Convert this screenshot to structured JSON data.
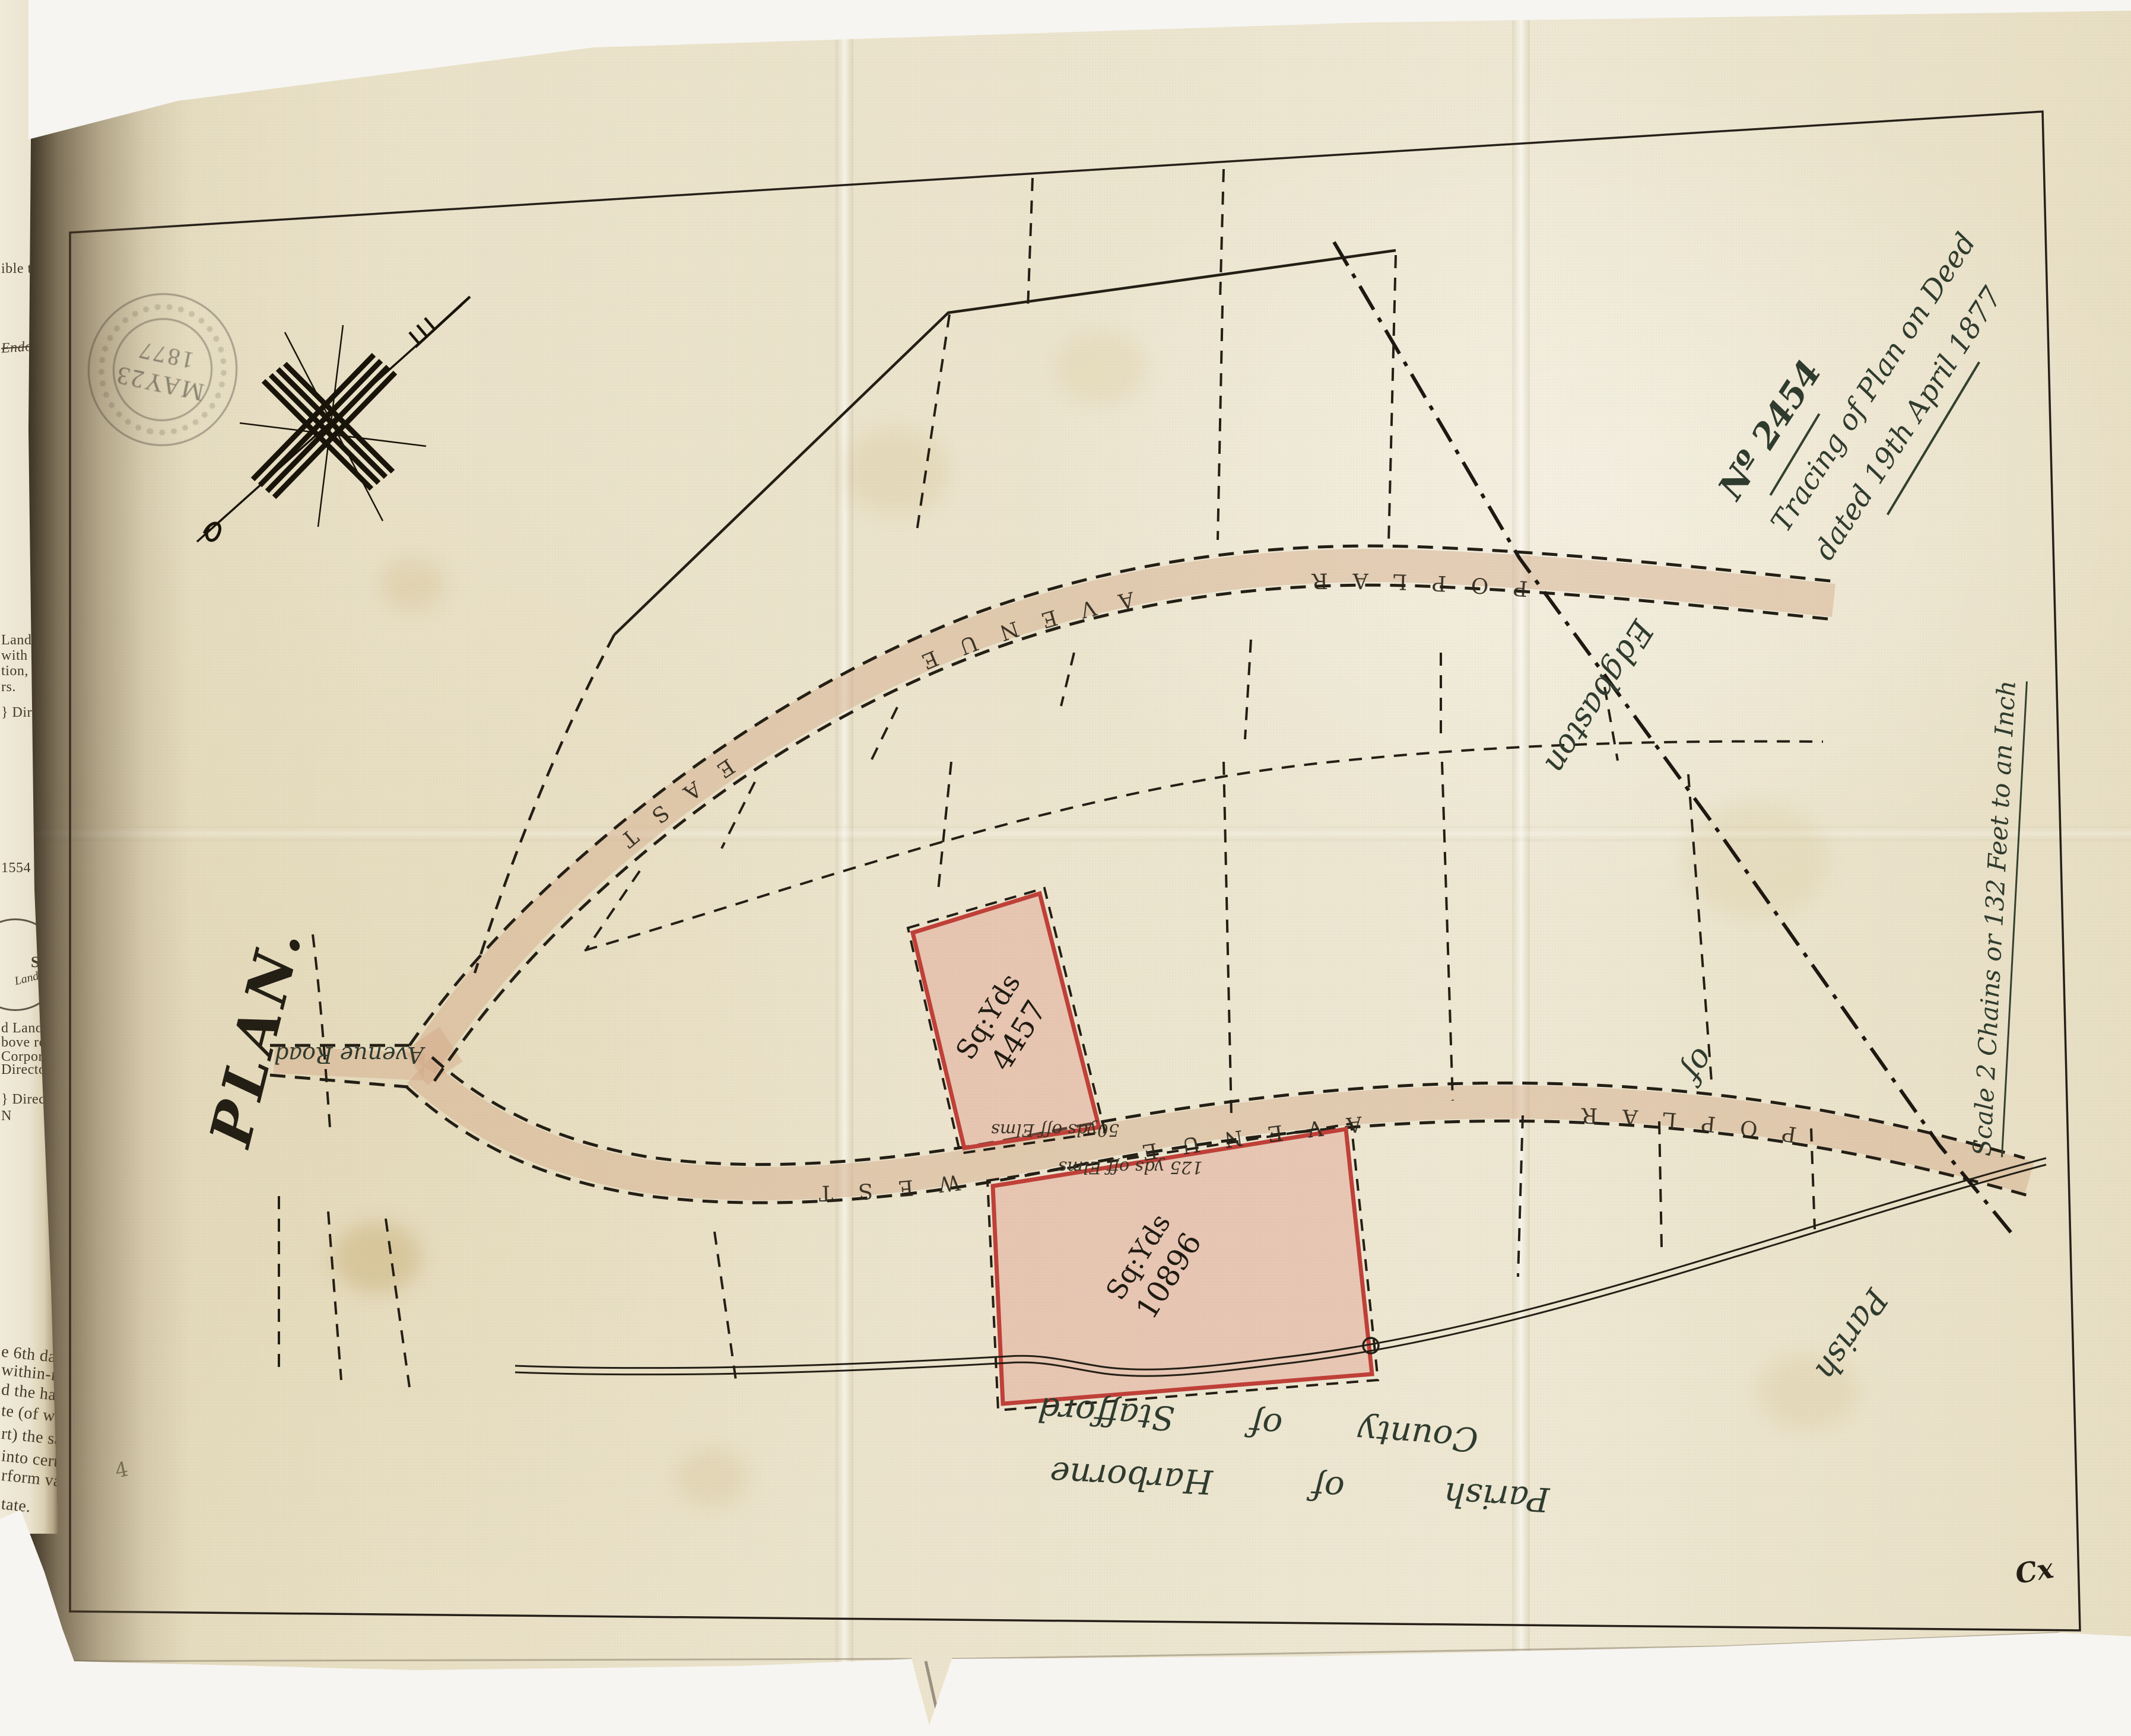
{
  "sheet": {
    "title_no": "Nº 2454",
    "title_line1": "Tracing of Plan on Deed",
    "title_line2": "dated 19th April 1877",
    "plan_heading": "PLAN.",
    "scale_note": "Scale 2 Chains or 132 Feet to an Inch",
    "corner_mark": "Cx",
    "margin_mark": "4",
    "stamp": {
      "month_day": "MAY23",
      "year": "1877"
    }
  },
  "map": {
    "road_word_poplar": "POPLAR",
    "road_word_avenue": "AVENUE",
    "road_word_east": "EAST",
    "road_word_west": "WEST",
    "avenue_road_label": "Avenue Road",
    "plots": [
      {
        "unit": "Sq:Yds",
        "area": "4457"
      },
      {
        "unit": "Sq:Yds",
        "area": "10896"
      }
    ],
    "tree_notes": [
      "50yds off Elms",
      "125 yds off Elms"
    ],
    "parish_boundary": {
      "word1": "Parish",
      "word2": "of",
      "word3": "Edgbaston"
    },
    "bottom_parish_line": "Parish of Harborne",
    "bottom_county_line": "County of Stafford"
  },
  "adjacent_page": {
    "fragments": [
      "ible ti",
      "Endors",
      "Land",
      "with",
      "tion, in",
      "rs.",
      "} Direct",
      "1554  9",
      "d Land a",
      "bove receip",
      "Corporati",
      "Directors.",
      "} Directo",
      "N",
      "e 6th day",
      "within-nam",
      "d the han",
      "te (of whi",
      "rt) the sa",
      "into certa",
      "rform vario",
      "tate."
    ],
    "seal_top": "S.",
    "seal_script": "Land Co"
  },
  "colors": {
    "plot_outline_red": "#bf4038",
    "plot_fill_pink": "rgba(221,133,121,0.32)",
    "road_buff": "rgba(210,168,135,0.45)",
    "ink": "#241f15",
    "script_ink": "#2f3b2e",
    "paper": "#eae2c9"
  }
}
